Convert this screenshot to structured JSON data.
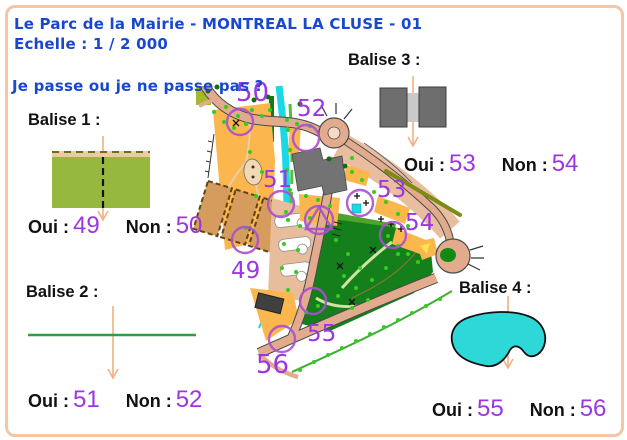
{
  "header": {
    "title": "Le Parc de la Mairie - MONTREAL LA CLUSE - 01",
    "scale": "Echelle : 1 / 2 000",
    "question": "Je passe ou je ne passe pas ?"
  },
  "balises": [
    {
      "label": "Balise 1 :",
      "symbol": "cultivated-field-boundary-symbol",
      "oui_label": "Oui :",
      "oui_value": "49",
      "non_label": "Non :",
      "non_value": "50"
    },
    {
      "label": "Balise 2 :",
      "symbol": "green-fence-line-symbol",
      "oui_label": "Oui :",
      "oui_value": "51",
      "non_label": "Non :",
      "non_value": "52"
    },
    {
      "label": "Balise 3 :",
      "symbol": "building-passage-symbol",
      "oui_label": "Oui :",
      "oui_value": "53",
      "non_label": "Non :",
      "non_value": "54"
    },
    {
      "label": "Balise 4 :",
      "symbol": "pond-symbol",
      "oui_label": "Oui :",
      "oui_value": "55",
      "non_label": "Non :",
      "non_value": "56"
    }
  ],
  "map": {
    "labels": [
      {
        "text": "50"
      },
      {
        "text": "52"
      },
      {
        "text": "51"
      },
      {
        "text": "53"
      },
      {
        "text": "54"
      },
      {
        "text": "49"
      },
      {
        "text": "55"
      },
      {
        "text": "56"
      }
    ]
  },
  "colors": {
    "title_blue": "#1847d1",
    "answer_purple": "#9c35e3",
    "control_circle_purple": "#a84fd2",
    "page_border": "#f2c6a6",
    "map_orange": "#fbb64d",
    "map_forest_green": "#157f1b",
    "map_water_cyan": "#1cd8e4",
    "arrow_orange": "#f2b184"
  }
}
